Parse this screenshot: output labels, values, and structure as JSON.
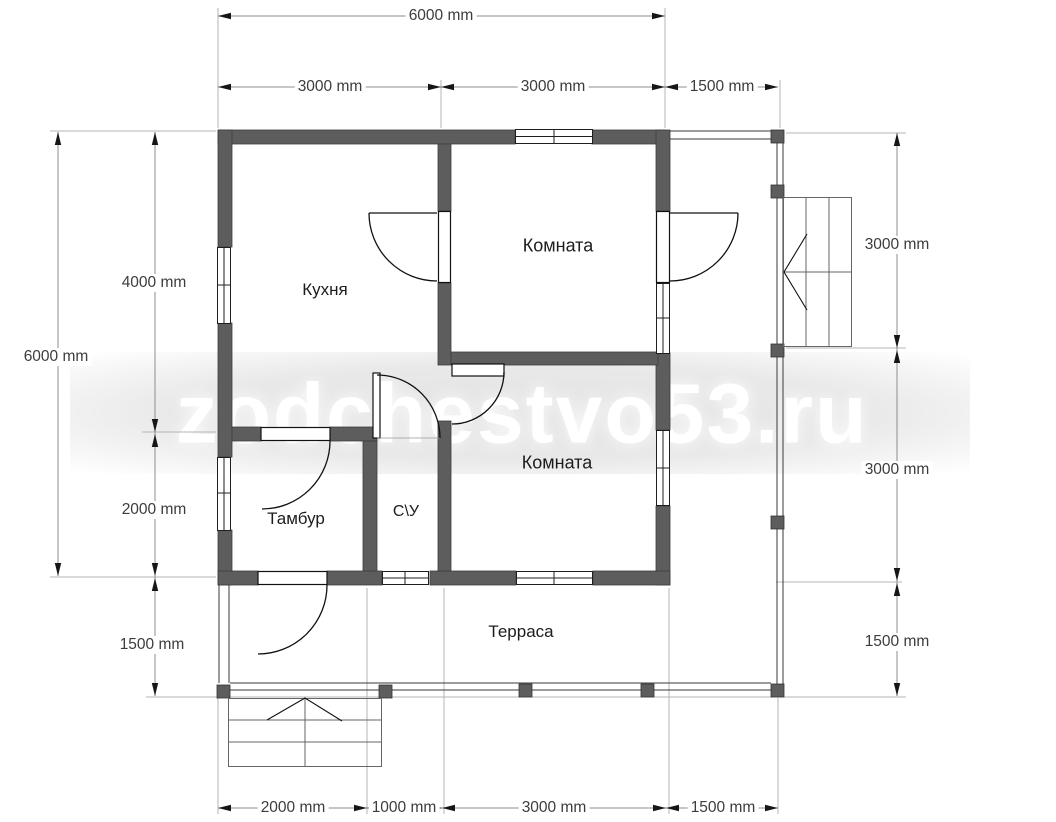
{
  "watermark": {
    "text": "zodchestvo53.ru"
  },
  "rooms": {
    "kitchen": "Кухня",
    "bedroom_top": "Комната",
    "bedroom_mid": "Комната",
    "vestibule": "Тамбур",
    "bathroom": "С\\У",
    "terrace": "Терраса"
  },
  "dimensions": {
    "top_total": "6000 mm",
    "top_seg1": "3000 mm",
    "top_seg2": "3000 mm",
    "top_seg3": "1500 mm",
    "left_total": "6000 mm",
    "left_seg1": "4000 mm",
    "left_seg2": "2000 mm",
    "left_seg3": "1500 mm",
    "right_seg1": "3000 mm",
    "right_seg2": "3000 mm",
    "right_seg3": "1500 mm",
    "bottom_seg1": "2000 mm",
    "bottom_seg2": "1000 mm",
    "bottom_seg3": "3000 mm",
    "bottom_seg4": "1500 mm"
  },
  "colors": {
    "wall": "#5d5d5d",
    "line": "#8d8d8d",
    "ext": "#b5b5b5",
    "arrow": "#161616",
    "dim-text": "#3c3c3c",
    "label": "#1c1c1c",
    "watermark": "#ffffff"
  }
}
